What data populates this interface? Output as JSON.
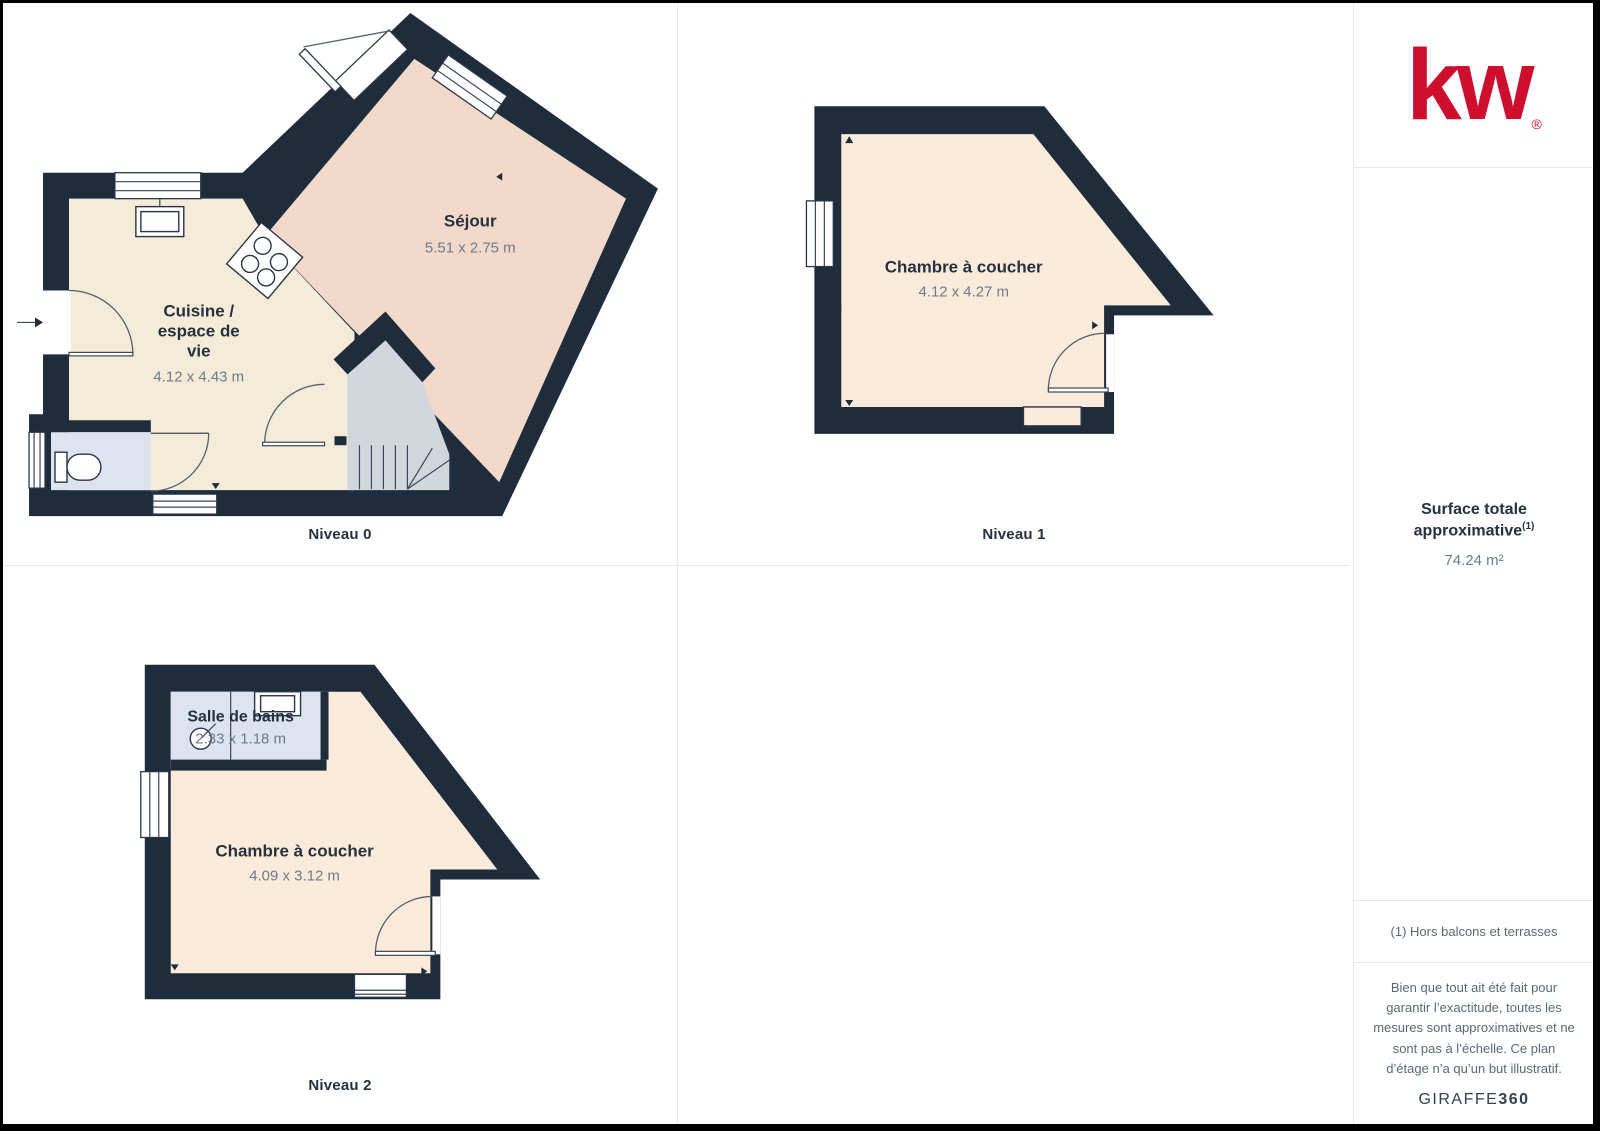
{
  "colors": {
    "wall": "#1E2C3C",
    "floor_sejour": "#F3D9C9",
    "floor_kitchen": "#F4ECD9",
    "floor_bedroom": "#FCEBDA",
    "floor_bathroom": "#DEE4EF",
    "floor_stairs": "#D2D7DE",
    "brand_red": "#CE0E2D",
    "text_dark": "#26313F",
    "text_muted": "#6E7B8A"
  },
  "levels": [
    {
      "caption": "Niveau 0",
      "rooms": {
        "sejour": {
          "name": "Séjour",
          "dims": "5.51 x 2.75 m"
        },
        "cuisine": {
          "name_line1": "Cuisine /",
          "name_line2": "espace de",
          "name_line3": "vie",
          "dims": "4.12 x 4.43 m"
        }
      }
    },
    {
      "caption": "Niveau 1",
      "rooms": {
        "chambre": {
          "name": "Chambre à coucher",
          "dims": "4.12 x 4.27 m"
        }
      }
    },
    {
      "caption": "Niveau 2",
      "rooms": {
        "salle_de_bains": {
          "name": "Salle de bains",
          "dims": "2.33 x 1.18 m"
        },
        "chambre": {
          "name": "Chambre à coucher",
          "dims": "4.09 x 3.12 m"
        }
      }
    }
  ],
  "sidebar": {
    "logo_text": "kw",
    "logo_registered": "®",
    "surface_title_line1": "Surface totale",
    "surface_title_line2": "approximative",
    "surface_title_sup": "(1)",
    "surface_value": "74.24 m²",
    "footnote": "(1) Hors balcons et terrasses",
    "disclaimer": "Bien que tout ait été fait pour garantir l’exactitude, toutes les mesures sont approximatives et ne sont pas à l’échelle. Ce plan d’étage n’a qu’un but illustratif.",
    "maker_regular": "GIRAFFE",
    "maker_bold": "360"
  }
}
